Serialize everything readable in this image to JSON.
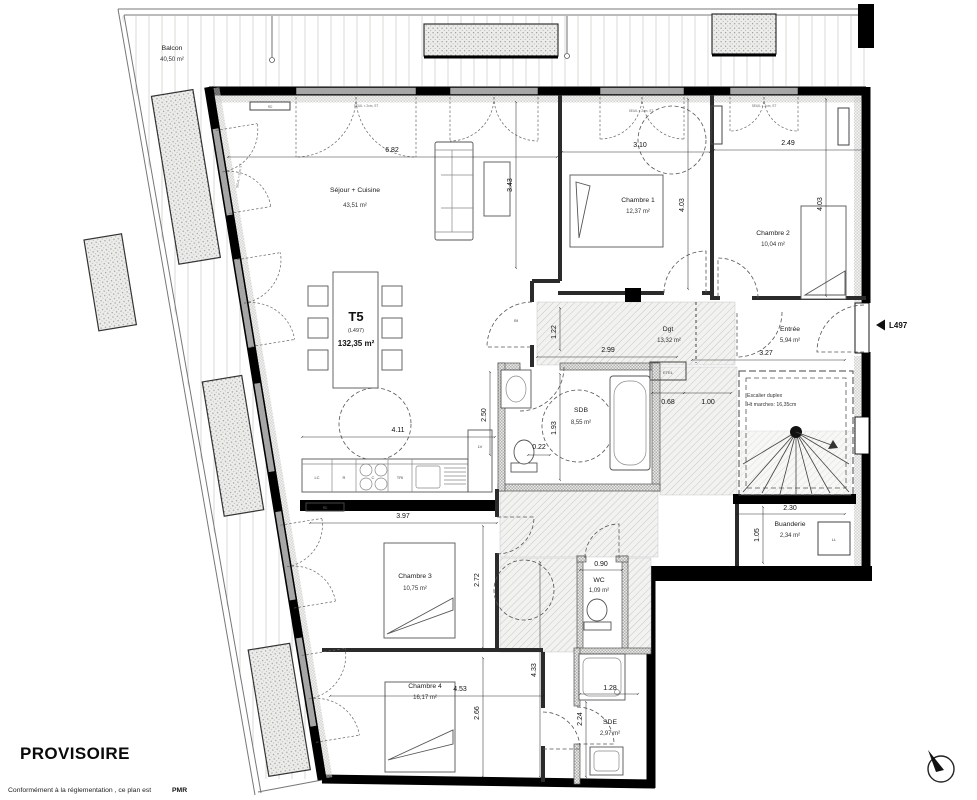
{
  "plan": {
    "stamp": "PROVISOIRE",
    "note": "Conformément à la réglementation , ce plan est",
    "note_bold": "PMR",
    "door_ref": "L497",
    "type": "T5",
    "lot": "(L497)",
    "total_area": "132,35 m²"
  },
  "rooms": [
    {
      "name": "Balcon",
      "area": "40,50 m²"
    },
    {
      "name": "Séjour + Cuisine",
      "area": "43,51 m²"
    },
    {
      "name": "Chambre 1",
      "area": "12,37 m²"
    },
    {
      "name": "Chambre 2",
      "area": "10,04 m²"
    },
    {
      "name": "Entrée",
      "area": "5,94 m²"
    },
    {
      "name": "Dgt",
      "area": "13,32 m²"
    },
    {
      "name": "SDB",
      "area": "8,55 m²"
    },
    {
      "name": "Escalier duplex",
      "area": "Ht marches: 16,35cm"
    },
    {
      "name": "Buanderie",
      "area": "2,34 m²"
    },
    {
      "name": "Chambre 3",
      "area": "10,75 m²"
    },
    {
      "name": "WC",
      "area": "1,09 m²"
    },
    {
      "name": "Chambre 4",
      "area": "16,17 m²"
    },
    {
      "name": "SDE",
      "area": "2,97 m²"
    }
  ],
  "dims": {
    "sejour_w": "6.82",
    "sejour_d": "3.43",
    "ch1_w": "3.10",
    "ch1_l": "4.03",
    "ch2_w": "2.49",
    "ch2_l": "4.03",
    "entree_w": "3.27",
    "dgt_w": "2.99",
    "vest_w": "1.22",
    "sdb_w": "1.93",
    "wc_off": "0.22",
    "etel_w": "0.68",
    "pass_w": "1.00",
    "kitchen_w": "4.11",
    "kitchen_d": "2.50",
    "ch3_w": "3.97",
    "ch3_l": "2.72",
    "buand_w": "2.30",
    "buand_d": "1.05",
    "wc_w": "0.90",
    "ch4_w": "4.53",
    "ch4_l": "2.66",
    "corr_l": "4.33",
    "sde_l": "2.24",
    "shower_w": "1.28"
  },
  "annotations": {
    "etel": "ETEL",
    "ll": "LL",
    "lv": "LV",
    "lc": "LC",
    "r": "R",
    "tri": "TRI",
    "c": "C",
    "bf": "Bf",
    "rd": "RD",
    "seuil": "SEUIL < 2cm, ST"
  }
}
